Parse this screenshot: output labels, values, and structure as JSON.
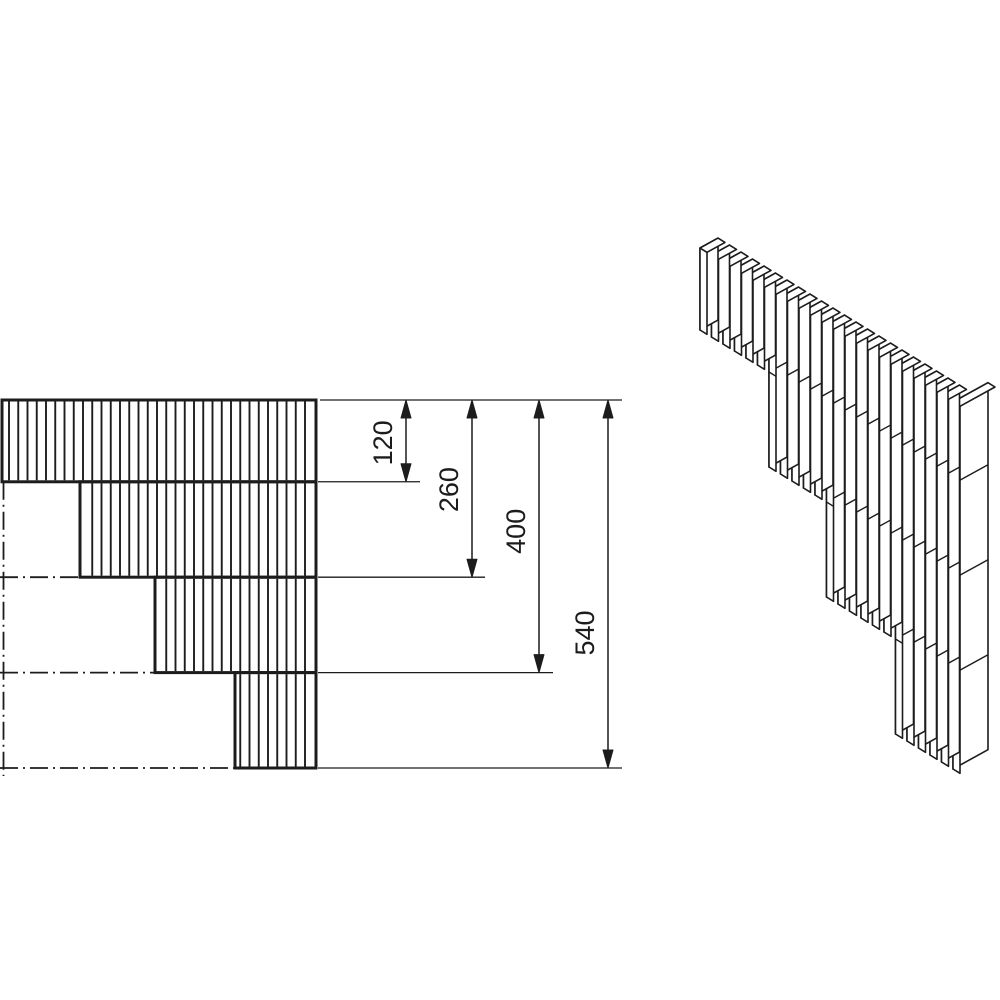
{
  "figure": {
    "type": "technical-drawing",
    "description": "Stepped corner element built from vertical slats: front elevation with stacked hatched rows (left) and isometric view of the slatted assembly (right)",
    "background": "#ffffff",
    "line_color": "#1c1c1c"
  },
  "dimensions": [
    {
      "label": "120",
      "value": 120
    },
    {
      "label": "260",
      "value": 260
    },
    {
      "label": "400",
      "value": 400
    },
    {
      "label": "540",
      "value": 540
    }
  ],
  "elevation": {
    "x_left": 2,
    "y_top": 400,
    "x_right": 316,
    "scale_px_per_unit": 0.6815,
    "row_bounds_units": [
      0,
      120,
      260,
      400,
      540
    ],
    "row_left_offsets_px": [
      0,
      78,
      153,
      233
    ],
    "hatch_spacing_px": 9.25,
    "dim_line_x": [
      406,
      472,
      539,
      608
    ],
    "ext_line_end_x": [
      622,
      420,
      485,
      553,
      622
    ],
    "label_y_offsets": [
      2,
      1,
      -5,
      49
    ],
    "label_x_gap": 21
  },
  "isometric": {
    "origin": [
      700,
      248
    ],
    "pitch": [
      11.5,
      7
    ],
    "thickness_vec": [
      7,
      4.3
    ],
    "depth_vec": [
      18,
      -9.9
    ],
    "corner_depth_vec": [
      35,
      -19.3
    ],
    "board_lengths_px": [
      82,
      177,
      272,
      367
    ],
    "group_counts": [
      6,
      5,
      6,
      6
    ],
    "joint_heights_px": [
      82,
      177,
      272
    ]
  }
}
